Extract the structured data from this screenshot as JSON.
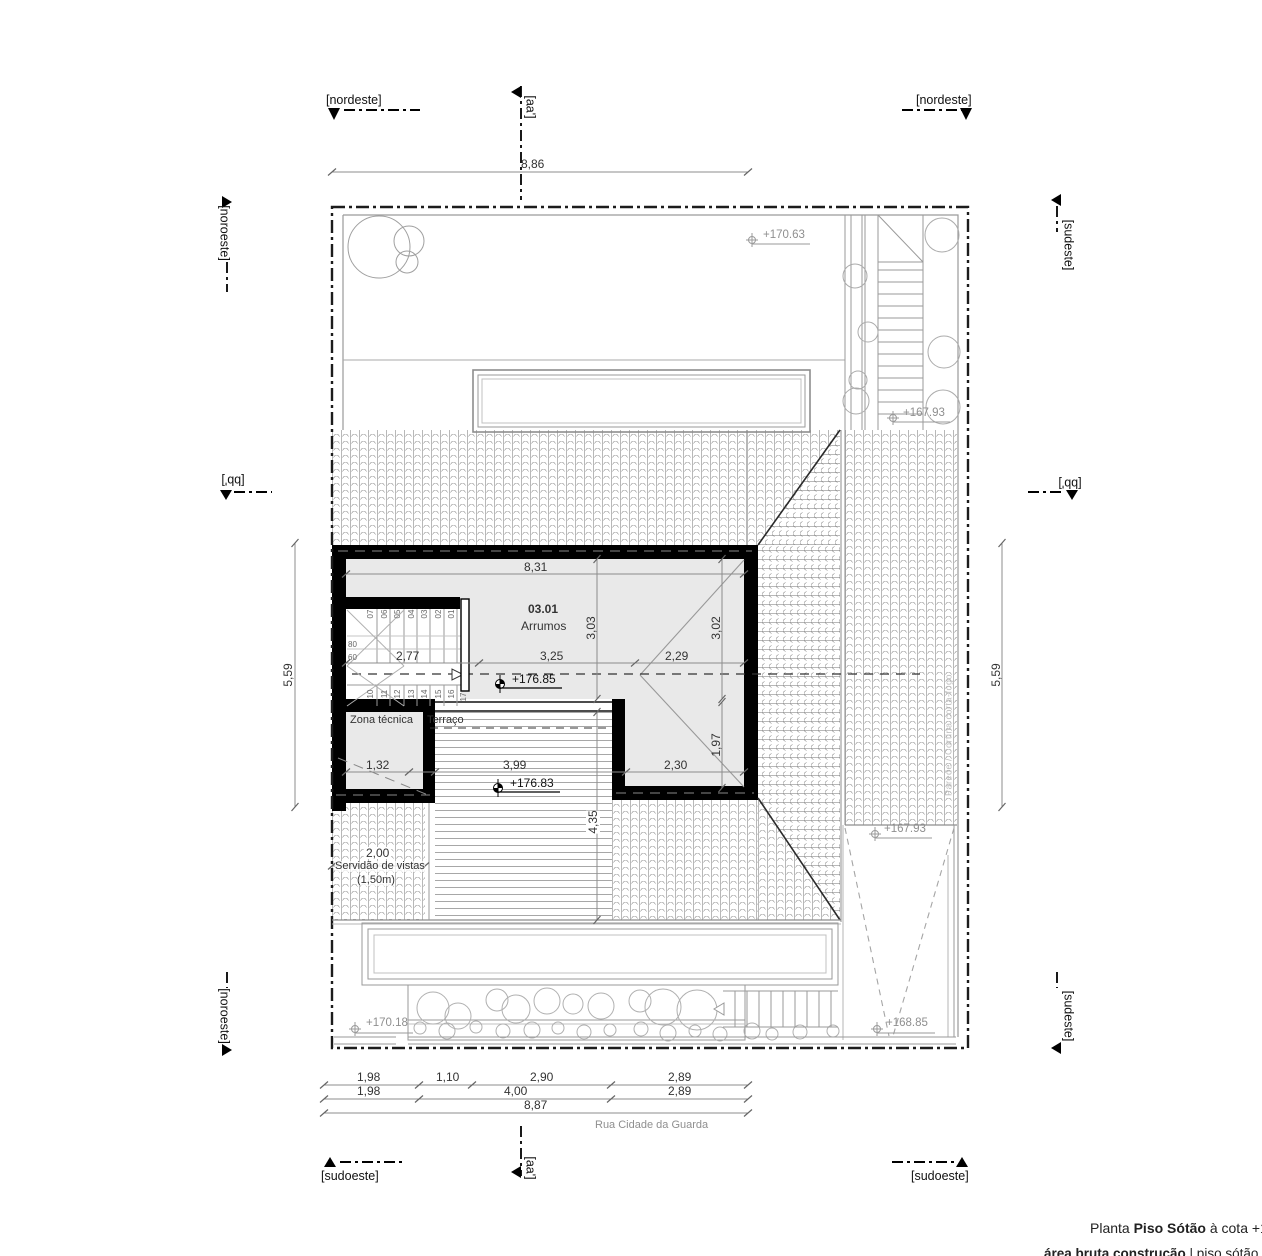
{
  "markers": {
    "nordeste_left": "[nordeste]",
    "nordeste_right": "[nordeste]",
    "noroeste_top": "[noroeste]",
    "noroeste_bottom": "[noroeste]",
    "sudeste_top": "[sudeste]",
    "sudeste_bottom": "[sudeste]",
    "sudoeste_left": "[sudoeste]",
    "sudoeste_right": "[sudoeste]",
    "aa_top": "[aa']",
    "aa_bottom": "[aa']",
    "bb_left": "[bb']",
    "bb_right": "[bb']"
  },
  "rooms": {
    "number": "03.01",
    "name": "Arrumos",
    "zona_tecnica": "Zona técnica",
    "terraco": "Terraço",
    "servidao_line1": "Servidão de vistas",
    "servidao_line2": "(1,50m)"
  },
  "levels": {
    "garden_top": "+170.63",
    "street_top": "+167.93",
    "street_mid": "+167.93",
    "ramp": "+168.85",
    "garden_bottom": "+170.18",
    "attic": "+176.85",
    "terrace": "+176.83"
  },
  "dims": {
    "top": "8,86",
    "plan_width": "8,31",
    "stair": "2,77",
    "room_mid": "3,25",
    "room_right": "2,29",
    "height_left": "3,03",
    "height_right": "3,02",
    "ext_height": "1,97",
    "ext_width": "2,30",
    "zona": "1,32",
    "terrace_w": "3,99",
    "terrace_h": "4,35",
    "servidao": "2,00",
    "side_left": "5,59",
    "side_right": "5,59",
    "b1": [
      "1,98",
      "1,10",
      "2,90",
      "2,89"
    ],
    "b2": [
      "1,98",
      "4,00",
      "2,89"
    ],
    "b3": "8,87"
  },
  "stairs": {
    "top": [
      "07",
      "06",
      "05",
      "04",
      "03",
      "02",
      "01"
    ],
    "bottom": [
      "10",
      "11",
      "12",
      "13",
      "14",
      "15",
      "16"
    ],
    "last": "17",
    "riser_a": "80",
    "riser_b": "60"
  },
  "street": "Rua Cidade da Guarda",
  "firewall_note": "Parede / Cortina corta-fogo",
  "title": {
    "p1": "Planta ",
    "b1": "Piso Sótão",
    "s1": " à cota +178",
    "b2": "área bruta construção",
    "s2": " | piso sótão = 03"
  }
}
